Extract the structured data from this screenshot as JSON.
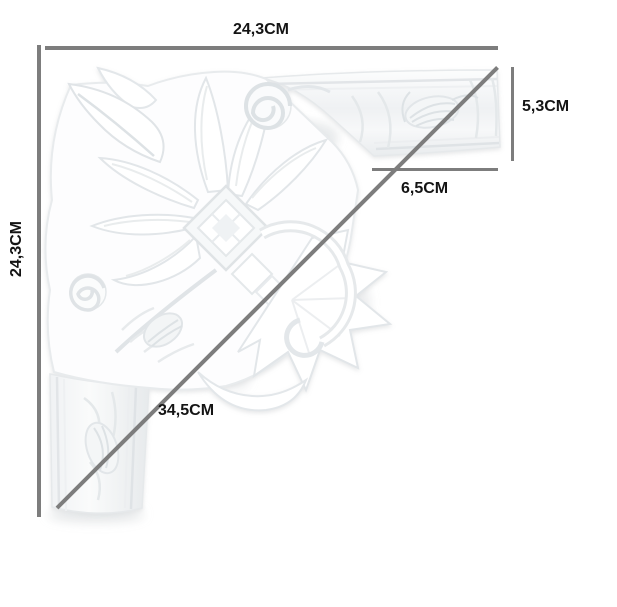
{
  "canvas": {
    "width_px": 617,
    "height_px": 607,
    "background": "#ffffff"
  },
  "product_diagram": {
    "subject": "ornate-corner-moulding",
    "unit": "CM",
    "colors": {
      "dimension_line": "#7d7d7d",
      "label_text": "#141414",
      "moulding_shading": "#e6e9eb"
    },
    "labels": {
      "top_width": "24,3CM",
      "left_height": "24,3CM",
      "right_profile_height": "5,3CM",
      "inner_profile_width": "6,5CM",
      "diagonal_length": "34,5CM"
    }
  }
}
